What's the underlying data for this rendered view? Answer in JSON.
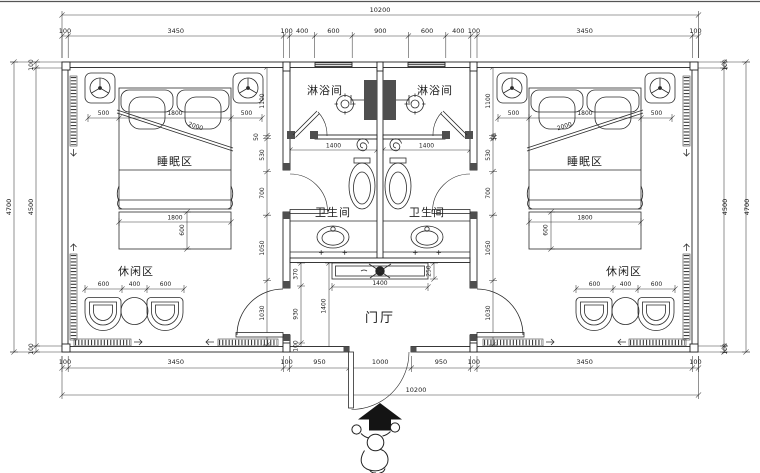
{
  "plan": {
    "rooms": {
      "shower_left": "淋浴间",
      "shower_right": "淋浴间",
      "wc_left": "卫生间",
      "wc_right": "卫生间",
      "sleep_left": "睡眠区",
      "sleep_right": "睡眠区",
      "leisure_left": "休闲区",
      "leisure_right": "休闲区",
      "foyer": "门厅"
    },
    "dims": {
      "overall_top": "10200",
      "overall_bottom": "10200",
      "top": [
        "100",
        "3450",
        "100",
        "400",
        "600",
        "900",
        "600",
        "400",
        "100",
        "3450",
        "100"
      ],
      "bottom": [
        "100",
        "3450",
        "100",
        "950",
        "1000",
        "950",
        "100",
        "3450",
        "100"
      ],
      "left_outer": "4700",
      "left_inner": "4500",
      "left_wall_top": "100",
      "left_wall_bottom": "100",
      "right_outer": "4700",
      "right_inner": "4500",
      "right_wall_top": "100",
      "right_wall_bottom": "100",
      "bed_left": [
        "500",
        "1800",
        "500"
      ],
      "bed_right": [
        "500",
        "1800",
        "500"
      ],
      "bed_diag_left": "2000",
      "bed_diag_right": "2000",
      "bench_width_left": "1800",
      "bench_depth_left": "600",
      "bench_width_right": "1800",
      "bench_depth_right": "600",
      "chain_left": [
        "1100",
        "50",
        "530",
        "700",
        "1050",
        "1030"
      ],
      "chain_right": [
        "1100",
        "50",
        "530",
        "700",
        "1050",
        "1030"
      ],
      "leisure_left": [
        "600",
        "400",
        "600"
      ],
      "leisure_right": [
        "600",
        "400",
        "600"
      ],
      "shower_left_width": "1400",
      "shower_right_width": "1400",
      "counter_width": "1400",
      "counter_depth": "250",
      "foyer_chain": [
        "370",
        "930",
        "100"
      ],
      "foyer_depth": "1400"
    }
  }
}
